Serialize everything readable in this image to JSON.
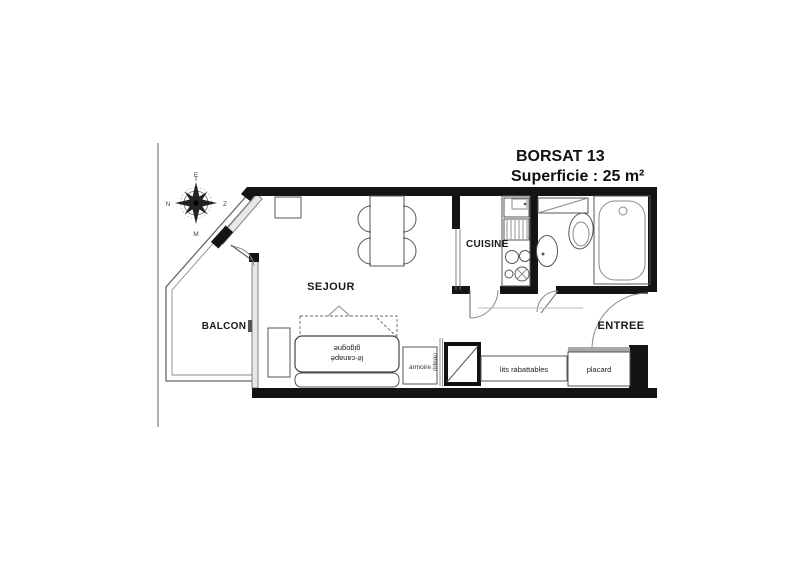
{
  "title": {
    "line1": "BORSAT 13",
    "line2": "Superficie : 25 m²"
  },
  "rooms": {
    "balcon": "BALCON",
    "sejour": "SEJOUR",
    "cuisine": "CUISINE",
    "entree": "ENTREE"
  },
  "furniture": {
    "armoire": "armoire",
    "rideau": "rideau",
    "lits_rabattables": "lits rabattables",
    "placard": "placard",
    "sofa_line1": "lit-canapé",
    "sofa_line2": "gigogne"
  },
  "compass": {
    "top": "E",
    "right": "Z",
    "bottom": "M",
    "left": "N"
  },
  "colors": {
    "wall": "#141414",
    "thin_line": "#555555",
    "glazing_fill": "#e8e8e8",
    "page_line": "#999999"
  }
}
